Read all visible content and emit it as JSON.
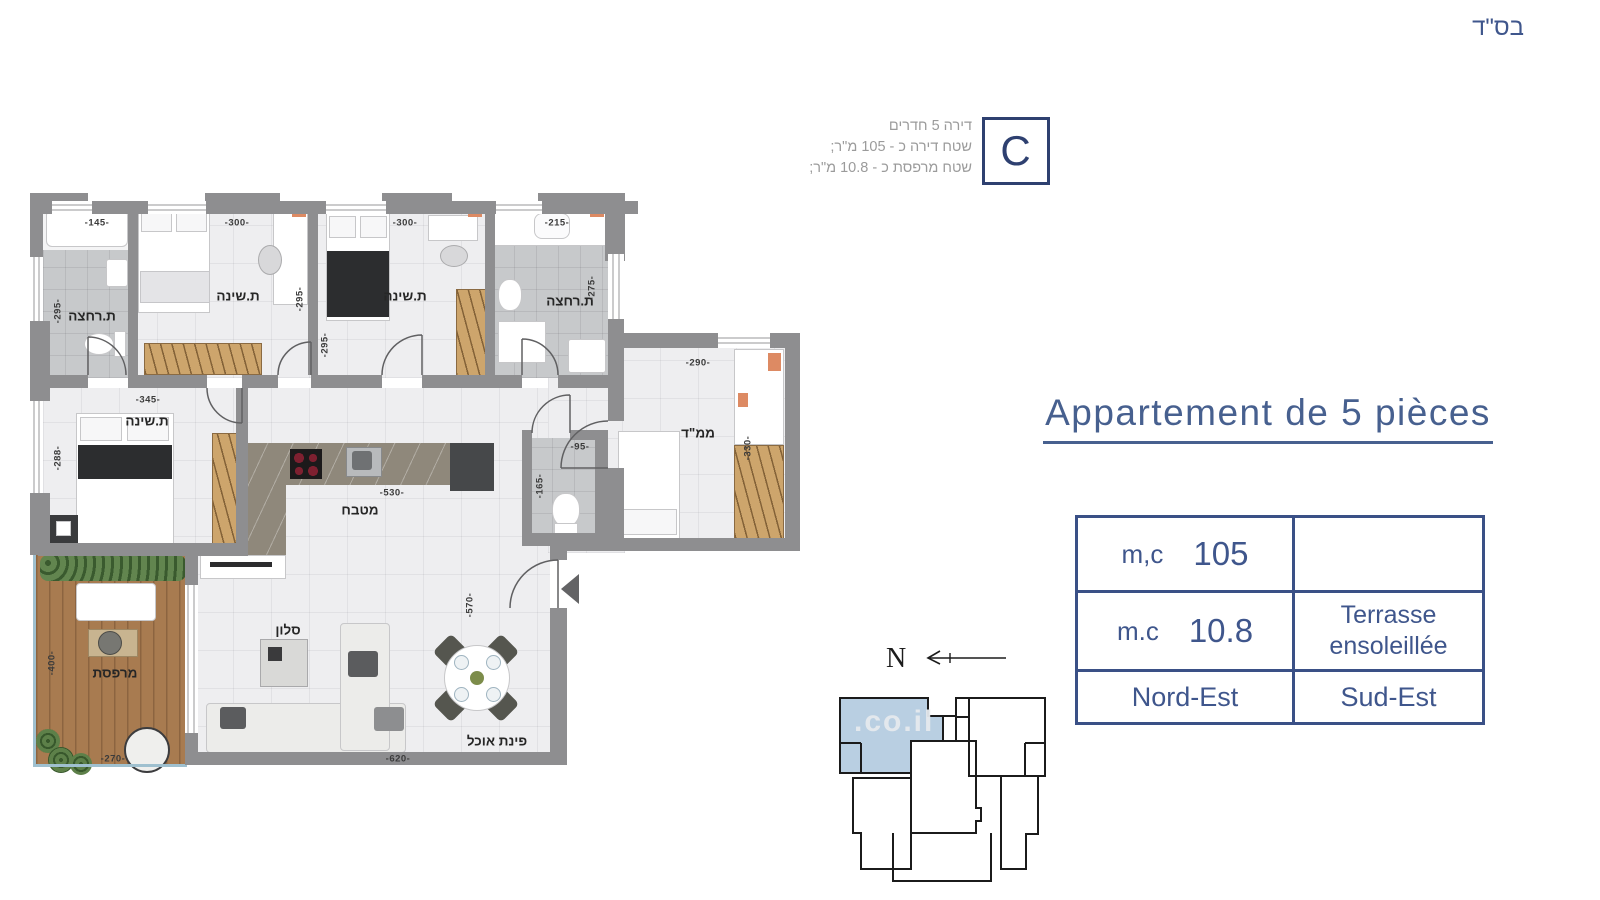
{
  "page": {
    "bsd": "בס\"ד"
  },
  "header": {
    "info_lines": [
      "דירה 5 חדרים",
      "שטח דירה כ - 105 מ\"ר;",
      "שטח מרפסת כ - 10.8 מ\"ר;"
    ],
    "unit_letter": "C"
  },
  "title": "Appartement de 5 pièces",
  "table": {
    "rows": [
      {
        "label": "m,c",
        "value": "105",
        "right": ""
      },
      {
        "label": "m.c",
        "value": "10.8",
        "right": "Terrasse ensoleillée"
      },
      {
        "label": "Nord-Est",
        "value": "",
        "right": "Sud-Est"
      }
    ]
  },
  "compass": {
    "north": "N"
  },
  "keyplan": {
    "watermark": ".co.il"
  },
  "plan": {
    "rooms": [
      {
        "label": "ת.רחצה"
      },
      {
        "label": "ת.שינה"
      },
      {
        "label": "ת.שינה"
      },
      {
        "label": "ת.רחצה"
      },
      {
        "label": "ממ\"ד"
      },
      {
        "label": "ת.שינה"
      },
      {
        "label": "מטבח"
      },
      {
        "label": "סלון"
      },
      {
        "label": "מרפסת"
      },
      {
        "label": "פינת אוכל"
      }
    ],
    "dims": [
      {
        "text": "-145-"
      },
      {
        "text": "-295-"
      },
      {
        "text": "-300-"
      },
      {
        "text": "-295-"
      },
      {
        "text": "-300-"
      },
      {
        "text": "-295-"
      },
      {
        "text": "-215-"
      },
      {
        "text": "-275-"
      },
      {
        "text": "-290-"
      },
      {
        "text": "-330-"
      },
      {
        "text": "-345-"
      },
      {
        "text": "-288-"
      },
      {
        "text": "-530-"
      },
      {
        "text": "-95-"
      },
      {
        "text": "-165-"
      },
      {
        "text": "-400-"
      },
      {
        "text": "-270-"
      },
      {
        "text": "-620-"
      },
      {
        "text": "-570-"
      }
    ]
  },
  "colors": {
    "accent": "#3f568c",
    "wall": "#8e8e90",
    "tile": "#c7c9cb",
    "wood": "#cda56c",
    "deck": "#a87b50",
    "hedge": "#62854f",
    "highlight": "#b9cfe2"
  }
}
